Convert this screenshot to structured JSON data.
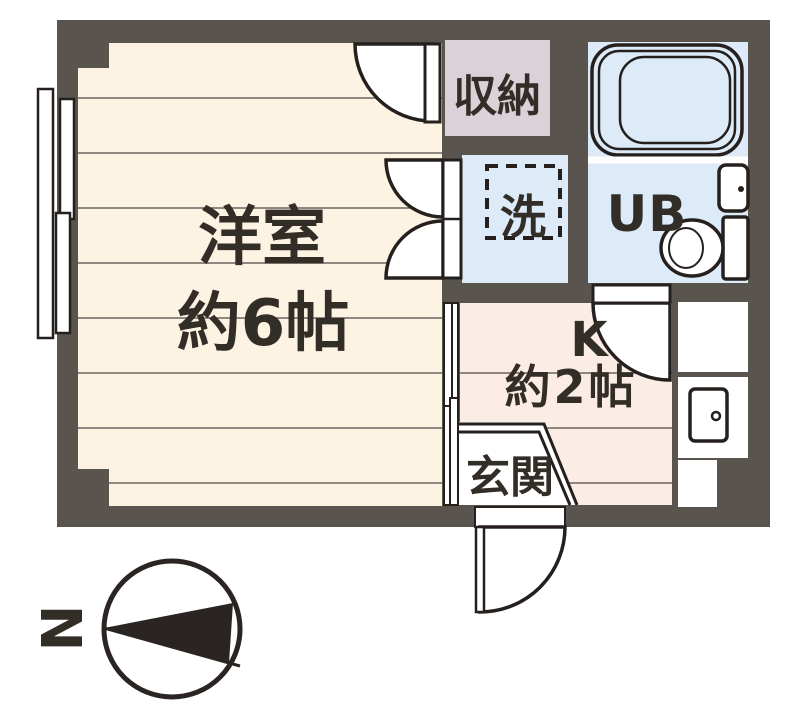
{
  "plan": {
    "rooms": {
      "western_room": {
        "name": "洋室",
        "size": "約6帖"
      },
      "kitchen": {
        "name": "K",
        "size": "約2帖"
      },
      "unit_bath": {
        "name": "UB"
      },
      "storage": {
        "name": "収納"
      },
      "laundry": {
        "name": "洗"
      },
      "entrance": {
        "name": "玄関"
      }
    },
    "compass": {
      "north": "N"
    },
    "colors": {
      "wall": "#5a544f",
      "wood_floor": "#fdf3e3",
      "kitchen_floor": "#fcece6",
      "wet_area": "#dcebf7",
      "storage_fill": "#d9d2d8",
      "floor_line": "#6b655f",
      "line": "#25201d",
      "text": "#332d28",
      "white": "#ffffff"
    }
  }
}
